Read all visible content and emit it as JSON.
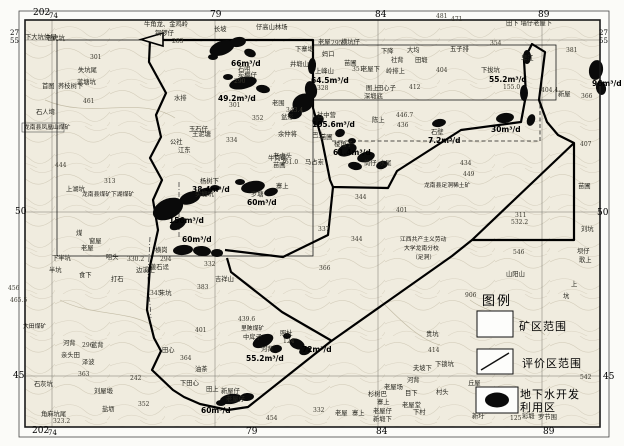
{
  "legend": {
    "title": "图例",
    "items": [
      {
        "symbol": "rectangle",
        "label": "矿区范围"
      },
      {
        "symbol": "diagonal-line",
        "label": "评价区范围"
      },
      {
        "symbol": "black-ellipse",
        "label": "地下水开发利用区"
      }
    ]
  },
  "colors": {
    "paper": "#f0ecdf",
    "blob": "#0a0a0a",
    "boundary": "#000000",
    "grid": "#6b6b66"
  },
  "map_labels": [
    {
      "t": "202",
      "x": 33,
      "y": 9,
      "c": "m"
    },
    {
      "t": "74",
      "x": 49,
      "y": 13,
      "c": "ms"
    },
    {
      "t": "79",
      "x": 210,
      "y": 11,
      "c": "m"
    },
    {
      "t": "84",
      "x": 375,
      "y": 11,
      "c": "m"
    },
    {
      "t": "89",
      "x": 538,
      "y": 11,
      "c": "m"
    },
    {
      "t": "202",
      "x": 32,
      "y": 427,
      "c": "m"
    },
    {
      "t": "74",
      "x": 48,
      "y": 430,
      "c": "ms"
    },
    {
      "t": "79",
      "x": 246,
      "y": 428,
      "c": "m"
    },
    {
      "t": "84",
      "x": 376,
      "y": 428,
      "c": "m"
    },
    {
      "t": "89",
      "x": 543,
      "y": 428,
      "c": "m"
    },
    {
      "t": "27",
      "x": 10,
      "y": 30,
      "c": "ms"
    },
    {
      "t": "55",
      "x": 10,
      "y": 38,
      "c": "ms"
    },
    {
      "t": "50",
      "x": 15,
      "y": 208,
      "c": "m"
    },
    {
      "t": "45",
      "x": 13,
      "y": 372,
      "c": "m"
    },
    {
      "t": "27",
      "x": 599,
      "y": 30,
      "c": "ms"
    },
    {
      "t": "55",
      "x": 599,
      "y": 38,
      "c": "ms"
    },
    {
      "t": "50",
      "x": 597,
      "y": 209,
      "c": "m"
    },
    {
      "t": "45",
      "x": 603,
      "y": 373,
      "c": "m"
    },
    {
      "t": "542",
      "x": 580,
      "y": 375,
      "c": "e"
    },
    {
      "t": "66m³/d",
      "x": 231,
      "y": 60,
      "c": "y"
    },
    {
      "t": "49.2m³/d",
      "x": 218,
      "y": 95,
      "c": "y"
    },
    {
      "t": "64.5m³/d",
      "x": 311,
      "y": 77,
      "c": "y"
    },
    {
      "t": "105.6m³/d",
      "x": 312,
      "y": 121,
      "c": "y"
    },
    {
      "t": "61.4m³/d",
      "x": 333,
      "y": 149,
      "c": "y"
    },
    {
      "t": "7.2m³/d",
      "x": 428,
      "y": 137,
      "c": "y"
    },
    {
      "t": "30m³/d",
      "x": 491,
      "y": 126,
      "c": "y"
    },
    {
      "t": "96m³/d",
      "x": 592,
      "y": 80,
      "c": "y"
    },
    {
      "t": "55.2m³/d",
      "x": 489,
      "y": 76,
      "c": "y"
    },
    {
      "t": "38.4m³/d",
      "x": 192,
      "y": 186,
      "c": "y"
    },
    {
      "t": "60m³/d",
      "x": 247,
      "y": 199,
      "c": "y"
    },
    {
      "t": "156m³/d",
      "x": 169,
      "y": 217,
      "c": "y"
    },
    {
      "t": "60m³/d",
      "x": 182,
      "y": 236,
      "c": "y"
    },
    {
      "t": "55.2m³/d",
      "x": 246,
      "y": 355,
      "c": "y"
    },
    {
      "t": "72m³/d",
      "x": 302,
      "y": 346,
      "c": "y"
    },
    {
      "t": "60m³/d",
      "x": 201,
      "y": 407,
      "c": "y"
    },
    {
      "t": "下大坑仲屋",
      "x": 25,
      "y": 35,
      "c": "p"
    },
    {
      "t": "老虎坑",
      "x": 46,
      "y": 36,
      "c": "p"
    },
    {
      "t": "301",
      "x": 90,
      "y": 55,
      "c": "e"
    },
    {
      "t": "失坑尾",
      "x": 78,
      "y": 68,
      "c": "p"
    },
    {
      "t": "首图",
      "x": 42,
      "y": 84,
      "c": "p"
    },
    {
      "t": "荞枝树下",
      "x": 58,
      "y": 84,
      "c": "p"
    },
    {
      "t": "蓝塘坑",
      "x": 77,
      "y": 80,
      "c": "p"
    },
    {
      "t": "461",
      "x": 83,
      "y": 99,
      "c": "e"
    },
    {
      "t": "石人塆",
      "x": 36,
      "y": 110,
      "c": "p"
    },
    {
      "t": "444",
      "x": 55,
      "y": 163,
      "c": "e"
    },
    {
      "t": "上湖坑",
      "x": 66,
      "y": 187,
      "c": "p"
    },
    {
      "t": "313",
      "x": 104,
      "y": 179,
      "c": "e"
    },
    {
      "t": "牛角龙、金鸡岭",
      "x": 144,
      "y": 22,
      "c": "p"
    },
    {
      "t": "铜锣仔",
      "x": 155,
      "y": 31,
      "c": "p"
    },
    {
      "t": "283",
      "x": 172,
      "y": 39,
      "c": "e"
    },
    {
      "t": "长坡",
      "x": 214,
      "y": 27,
      "c": "p"
    },
    {
      "t": "仔高山林场",
      "x": 256,
      "y": 25,
      "c": "p"
    },
    {
      "t": "石咀",
      "x": 238,
      "y": 67,
      "c": "p"
    },
    {
      "t": "炭棚仔",
      "x": 238,
      "y": 73,
      "c": "p"
    },
    {
      "t": "290",
      "x": 234,
      "y": 79,
      "c": "e"
    },
    {
      "t": "老围",
      "x": 272,
      "y": 101,
      "c": "p"
    },
    {
      "t": "301",
      "x": 229,
      "y": 103,
      "c": "e"
    },
    {
      "t": "水排",
      "x": 174,
      "y": 96,
      "c": "p"
    },
    {
      "t": "玉石仔",
      "x": 189,
      "y": 127,
      "c": "p"
    },
    {
      "t": "王泥塘",
      "x": 192,
      "y": 132,
      "c": "p"
    },
    {
      "t": "公社",
      "x": 170,
      "y": 140,
      "c": "p"
    },
    {
      "t": "江东",
      "x": 178,
      "y": 148,
      "c": "p"
    },
    {
      "t": "井塅山",
      "x": 290,
      "y": 62,
      "c": "p"
    },
    {
      "t": "上峰山",
      "x": 315,
      "y": 69,
      "c": "p"
    },
    {
      "t": "328",
      "x": 317,
      "y": 86,
      "c": "e"
    },
    {
      "t": "老屋",
      "x": 318,
      "y": 40,
      "c": "p"
    },
    {
      "t": "295",
      "x": 331,
      "y": 41,
      "c": "e"
    },
    {
      "t": "横坑仔",
      "x": 341,
      "y": 40,
      "c": "p"
    },
    {
      "t": "下寨塅",
      "x": 295,
      "y": 47,
      "c": "p"
    },
    {
      "t": "妈口",
      "x": 322,
      "y": 52,
      "c": "p"
    },
    {
      "t": "下降",
      "x": 381,
      "y": 49,
      "c": "p"
    },
    {
      "t": "大均",
      "x": 407,
      "y": 48,
      "c": "p"
    },
    {
      "t": "苗圃",
      "x": 344,
      "y": 61,
      "c": "p"
    },
    {
      "t": "社背",
      "x": 391,
      "y": 58,
      "c": "p"
    },
    {
      "t": "田塅",
      "x": 415,
      "y": 58,
      "c": "p"
    },
    {
      "t": "351",
      "x": 352,
      "y": 67,
      "c": "e"
    },
    {
      "t": "老屋下",
      "x": 361,
      "y": 67,
      "c": "p"
    },
    {
      "t": "岭排上",
      "x": 386,
      "y": 69,
      "c": "p"
    },
    {
      "t": "404",
      "x": 436,
      "y": 68,
      "c": "e"
    },
    {
      "t": "412",
      "x": 409,
      "y": 85,
      "c": "e"
    },
    {
      "t": "图上",
      "x": 366,
      "y": 86,
      "c": "p"
    },
    {
      "t": "田心子",
      "x": 377,
      "y": 86,
      "c": "p"
    },
    {
      "t": "深塅底",
      "x": 364,
      "y": 94,
      "c": "p"
    },
    {
      "t": "481",
      "x": 436,
      "y": 14,
      "c": "e"
    },
    {
      "t": "471",
      "x": 451,
      "y": 17,
      "c": "e"
    },
    {
      "t": "354",
      "x": 490,
      "y": 41,
      "c": "e"
    },
    {
      "t": "五子排",
      "x": 450,
      "y": 47,
      "c": "p"
    },
    {
      "t": "381",
      "x": 566,
      "y": 48,
      "c": "e"
    },
    {
      "t": "早江",
      "x": 521,
      "y": 56,
      "c": "p"
    },
    {
      "t": "田下 墙仔老屋下",
      "x": 506,
      "y": 21,
      "c": "p"
    },
    {
      "t": "下拔坑",
      "x": 481,
      "y": 68,
      "c": "p"
    },
    {
      "t": "155.0",
      "x": 503,
      "y": 85,
      "c": "e"
    },
    {
      "t": "404.4",
      "x": 541,
      "y": 88,
      "c": "e"
    },
    {
      "t": "新屋",
      "x": 558,
      "y": 92,
      "c": "p"
    },
    {
      "t": "366",
      "x": 581,
      "y": 94,
      "c": "e"
    },
    {
      "t": "343.4",
      "x": 286,
      "y": 108,
      "c": "e"
    },
    {
      "t": "盆形",
      "x": 281,
      "y": 115,
      "c": "p"
    },
    {
      "t": "余仲将",
      "x": 278,
      "y": 132,
      "c": "p"
    },
    {
      "t": "老虎头",
      "x": 273,
      "y": 154,
      "c": "p"
    },
    {
      "t": "361.0",
      "x": 281,
      "y": 160,
      "c": "e"
    },
    {
      "t": "社中营",
      "x": 317,
      "y": 113,
      "c": "p"
    },
    {
      "t": "陈上",
      "x": 372,
      "y": 118,
      "c": "p"
    },
    {
      "t": "446.7",
      "x": 396,
      "y": 113,
      "c": "e"
    },
    {
      "t": "436",
      "x": 397,
      "y": 123,
      "c": "e"
    },
    {
      "t": "巴上",
      "x": 312,
      "y": 133,
      "c": "p"
    },
    {
      "t": "石壁",
      "x": 431,
      "y": 130,
      "c": "p"
    },
    {
      "t": "楼角子",
      "x": 334,
      "y": 142,
      "c": "p"
    },
    {
      "t": "筒仔",
      "x": 364,
      "y": 161,
      "c": "p"
    },
    {
      "t": "水尾",
      "x": 379,
      "y": 161,
      "c": "p"
    },
    {
      "t": "352",
      "x": 252,
      "y": 116,
      "c": "e"
    },
    {
      "t": "334",
      "x": 226,
      "y": 138,
      "c": "e"
    },
    {
      "t": "苗圃",
      "x": 320,
      "y": 135,
      "c": "p"
    },
    {
      "t": "牛岗嵊",
      "x": 268,
      "y": 156,
      "c": "p"
    },
    {
      "t": "马占岽",
      "x": 305,
      "y": 160,
      "c": "p"
    },
    {
      "t": "苗圃",
      "x": 273,
      "y": 163,
      "c": "p"
    },
    {
      "t": "杨树下",
      "x": 200,
      "y": 179,
      "c": "p"
    },
    {
      "t": "实塅坑",
      "x": 195,
      "y": 192,
      "c": "p"
    },
    {
      "t": "罗塘",
      "x": 251,
      "y": 192,
      "c": "p"
    },
    {
      "t": "寨上",
      "x": 276,
      "y": 184,
      "c": "p"
    },
    {
      "t": "龙南县凤凰山煤矿",
      "x": 24,
      "y": 126,
      "c": "mn"
    },
    {
      "t": "龙南县煤矿下湖煤矿",
      "x": 82,
      "y": 193,
      "c": "mn"
    },
    {
      "t": "煤",
      "x": 76,
      "y": 231,
      "c": "p"
    },
    {
      "t": "窗屋",
      "x": 89,
      "y": 239,
      "c": "p"
    },
    {
      "t": "老屋",
      "x": 81,
      "y": 246,
      "c": "p"
    },
    {
      "t": "咀头",
      "x": 106,
      "y": 255,
      "c": "p"
    },
    {
      "t": "下半坑",
      "x": 52,
      "y": 256,
      "c": "p"
    },
    {
      "t": "半坑",
      "x": 49,
      "y": 268,
      "c": "p"
    },
    {
      "t": "食下",
      "x": 79,
      "y": 273,
      "c": "p"
    },
    {
      "t": "打石",
      "x": 111,
      "y": 277,
      "c": "p"
    },
    {
      "t": "330.2",
      "x": 127,
      "y": 257,
      "c": "e"
    },
    {
      "t": "294",
      "x": 160,
      "y": 257,
      "c": "e"
    },
    {
      "t": "边溪上",
      "x": 136,
      "y": 268,
      "c": "p"
    },
    {
      "t": "黄石迳",
      "x": 150,
      "y": 265,
      "c": "p"
    },
    {
      "t": "横岗",
      "x": 155,
      "y": 248,
      "c": "p"
    },
    {
      "t": "332",
      "x": 204,
      "y": 262,
      "c": "e"
    },
    {
      "t": "吉祥山",
      "x": 215,
      "y": 277,
      "c": "p"
    },
    {
      "t": "383",
      "x": 197,
      "y": 285,
      "c": "e"
    },
    {
      "t": "345",
      "x": 150,
      "y": 291,
      "c": "e"
    },
    {
      "t": "朱坑",
      "x": 159,
      "y": 291,
      "c": "p"
    },
    {
      "t": "337",
      "x": 318,
      "y": 227,
      "c": "e"
    },
    {
      "t": "366",
      "x": 319,
      "y": 266,
      "c": "e"
    },
    {
      "t": "344",
      "x": 355,
      "y": 195,
      "c": "e"
    },
    {
      "t": "344",
      "x": 351,
      "y": 237,
      "c": "e"
    },
    {
      "t": "401",
      "x": 396,
      "y": 208,
      "c": "e"
    },
    {
      "t": "434",
      "x": 460,
      "y": 161,
      "c": "e"
    },
    {
      "t": "449",
      "x": 463,
      "y": 172,
      "c": "e"
    },
    {
      "t": "龙南县足洞稀土矿",
      "x": 424,
      "y": 184,
      "c": "mn"
    },
    {
      "t": "江西共产主义劳动",
      "x": 400,
      "y": 238,
      "c": "mn"
    },
    {
      "t": "大学龙南分校",
      "x": 404,
      "y": 247,
      "c": "mn"
    },
    {
      "t": "（足洞）",
      "x": 412,
      "y": 256,
      "c": "mn"
    },
    {
      "t": "407",
      "x": 580,
      "y": 142,
      "c": "e"
    },
    {
      "t": "苗圃",
      "x": 578,
      "y": 184,
      "c": "p"
    },
    {
      "t": "刘坑",
      "x": 581,
      "y": 227,
      "c": "p"
    },
    {
      "t": "311",
      "x": 515,
      "y": 213,
      "c": "e"
    },
    {
      "t": "532.2",
      "x": 511,
      "y": 220,
      "c": "e"
    },
    {
      "t": "546",
      "x": 513,
      "y": 250,
      "c": "e"
    },
    {
      "t": "山阳山",
      "x": 506,
      "y": 272,
      "c": "p"
    },
    {
      "t": "上",
      "x": 571,
      "y": 282,
      "c": "p"
    },
    {
      "t": "坑",
      "x": 563,
      "y": 294,
      "c": "p"
    },
    {
      "t": "坝仔",
      "x": 577,
      "y": 249,
      "c": "p"
    },
    {
      "t": "歌上",
      "x": 579,
      "y": 258,
      "c": "p"
    },
    {
      "t": "906",
      "x": 465,
      "y": 293,
      "c": "e"
    },
    {
      "t": "456",
      "x": 8,
      "y": 286,
      "c": "e"
    },
    {
      "t": "465.5",
      "x": 10,
      "y": 298,
      "c": "e"
    },
    {
      "t": "大田煤矿",
      "x": 23,
      "y": 325,
      "c": "mn"
    },
    {
      "t": "河背",
      "x": 63,
      "y": 341,
      "c": "p"
    },
    {
      "t": "296",
      "x": 82,
      "y": 343,
      "c": "e"
    },
    {
      "t": "蓝背",
      "x": 91,
      "y": 343,
      "c": "p"
    },
    {
      "t": "亲头田",
      "x": 61,
      "y": 353,
      "c": "p"
    },
    {
      "t": "泽波",
      "x": 82,
      "y": 360,
      "c": "p"
    },
    {
      "t": "363",
      "x": 78,
      "y": 372,
      "c": "e"
    },
    {
      "t": "242",
      "x": 130,
      "y": 376,
      "c": "e"
    },
    {
      "t": "石灰坑",
      "x": 34,
      "y": 382,
      "c": "p"
    },
    {
      "t": "刘屋塅",
      "x": 94,
      "y": 389,
      "c": "p"
    },
    {
      "t": "角麻坑尾",
      "x": 41,
      "y": 412,
      "c": "p"
    },
    {
      "t": "323.2",
      "x": 53,
      "y": 419,
      "c": "e"
    },
    {
      "t": "盐坜",
      "x": 102,
      "y": 407,
      "c": "p"
    },
    {
      "t": "352",
      "x": 138,
      "y": 402,
      "c": "e"
    },
    {
      "t": "田心",
      "x": 162,
      "y": 348,
      "c": "p"
    },
    {
      "t": "364",
      "x": 180,
      "y": 356,
      "c": "e"
    },
    {
      "t": "油茶",
      "x": 195,
      "y": 367,
      "c": "p"
    },
    {
      "t": "下田心",
      "x": 180,
      "y": 381,
      "c": "p"
    },
    {
      "t": "401",
      "x": 195,
      "y": 328,
      "c": "e"
    },
    {
      "t": "439.6",
      "x": 238,
      "y": 317,
      "c": "e"
    },
    {
      "t": "里陂煤矿",
      "x": 241,
      "y": 327,
      "c": "mn"
    },
    {
      "t": "中戽子",
      "x": 243,
      "y": 335,
      "c": "p"
    },
    {
      "t": "照杜",
      "x": 280,
      "y": 331,
      "c": "p"
    },
    {
      "t": "124",
      "x": 283,
      "y": 339,
      "c": "e"
    },
    {
      "t": "河背",
      "x": 261,
      "y": 347,
      "c": "p"
    },
    {
      "t": "田上",
      "x": 206,
      "y": 387,
      "c": "p"
    },
    {
      "t": "新屋仔",
      "x": 221,
      "y": 389,
      "c": "p"
    },
    {
      "t": "老屋仔",
      "x": 226,
      "y": 397,
      "c": "p"
    },
    {
      "t": "454",
      "x": 266,
      "y": 416,
      "c": "e"
    },
    {
      "t": "332",
      "x": 313,
      "y": 408,
      "c": "e"
    },
    {
      "t": "老屋场",
      "x": 384,
      "y": 385,
      "c": "p"
    },
    {
      "t": "杉树巴",
      "x": 368,
      "y": 392,
      "c": "p"
    },
    {
      "t": "寨上",
      "x": 377,
      "y": 400,
      "c": "p"
    },
    {
      "t": "老屋",
      "x": 335,
      "y": 411,
      "c": "p"
    },
    {
      "t": "寨上",
      "x": 352,
      "y": 411,
      "c": "p"
    },
    {
      "t": "老屋仔",
      "x": 373,
      "y": 409,
      "c": "p"
    },
    {
      "t": "新塅下",
      "x": 373,
      "y": 417,
      "c": "p"
    },
    {
      "t": "河背",
      "x": 407,
      "y": 378,
      "c": "p"
    },
    {
      "t": "目下",
      "x": 405,
      "y": 391,
      "c": "p"
    },
    {
      "t": "老屋堂",
      "x": 402,
      "y": 403,
      "c": "p"
    },
    {
      "t": "下村",
      "x": 413,
      "y": 410,
      "c": "p"
    },
    {
      "t": "夫坡下",
      "x": 413,
      "y": 366,
      "c": "p"
    },
    {
      "t": "贵坑",
      "x": 426,
      "y": 332,
      "c": "p"
    },
    {
      "t": "414",
      "x": 428,
      "y": 348,
      "c": "e"
    },
    {
      "t": "下锁坑",
      "x": 435,
      "y": 362,
      "c": "p"
    },
    {
      "t": "丘屋",
      "x": 468,
      "y": 381,
      "c": "p"
    },
    {
      "t": "村头",
      "x": 436,
      "y": 390,
      "c": "p"
    },
    {
      "t": "新圩",
      "x": 472,
      "y": 414,
      "c": "p"
    },
    {
      "t": "125",
      "x": 510,
      "y": 416,
      "c": "e"
    },
    {
      "t": "彩塅",
      "x": 522,
      "y": 414,
      "c": "p"
    },
    {
      "t": "罗节围",
      "x": 538,
      "y": 415,
      "c": "p"
    }
  ]
}
